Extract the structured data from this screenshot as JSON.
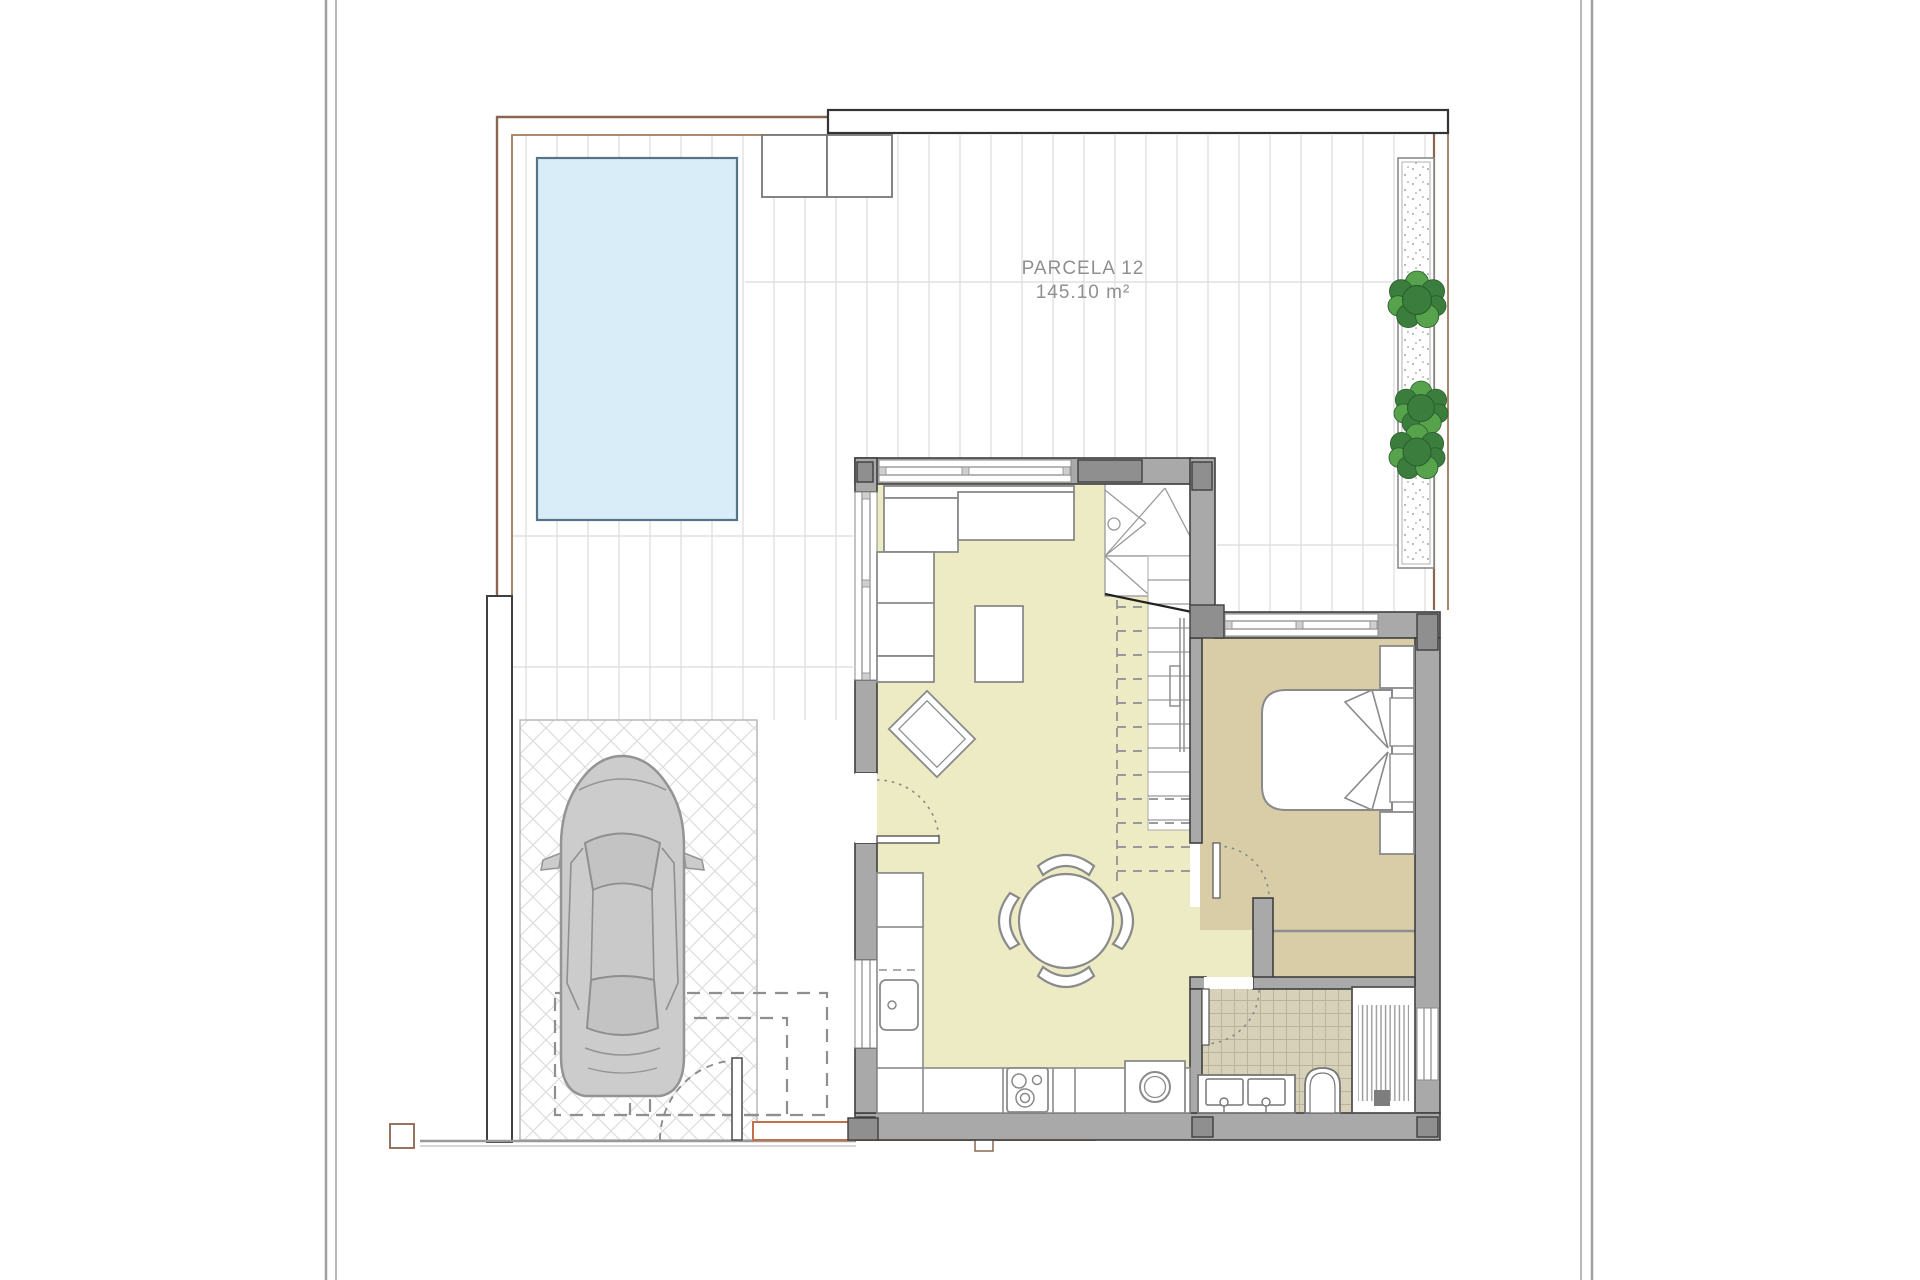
{
  "plan": {
    "parcel_label": "PARCELA 12",
    "parcel_area": "145.10 m²"
  },
  "counts": {
    "plants": 3,
    "dining_chairs": 4,
    "bathroom_sinks": 2
  },
  "colors": {
    "wall": "#a9a9a9",
    "wall_dark": "#8f8f8f",
    "wall_edge": "#3f3f3f",
    "floor_main": "#ecebc4",
    "floor_bedroom": "#d9cda8",
    "floor_bath": "#d7d1b9",
    "pool_fill": "#d9edf8",
    "pool_stroke": "#567487",
    "plant_green": "#3a7d3c",
    "plant_green_dark": "#2a5f2e",
    "plant_green_light": "#57a34c",
    "boundary_brown": "#8a6550",
    "boundary_brown_light": "#a1795e",
    "walkway_orange": "#c0714a",
    "car_body": "#cccccc",
    "car_stroke": "#949494",
    "label_gray": "#909090",
    "deck_line": "#e2e2e2",
    "sheet_border": "#a0a0a0",
    "furniture_stroke": "#8a8a8a"
  }
}
